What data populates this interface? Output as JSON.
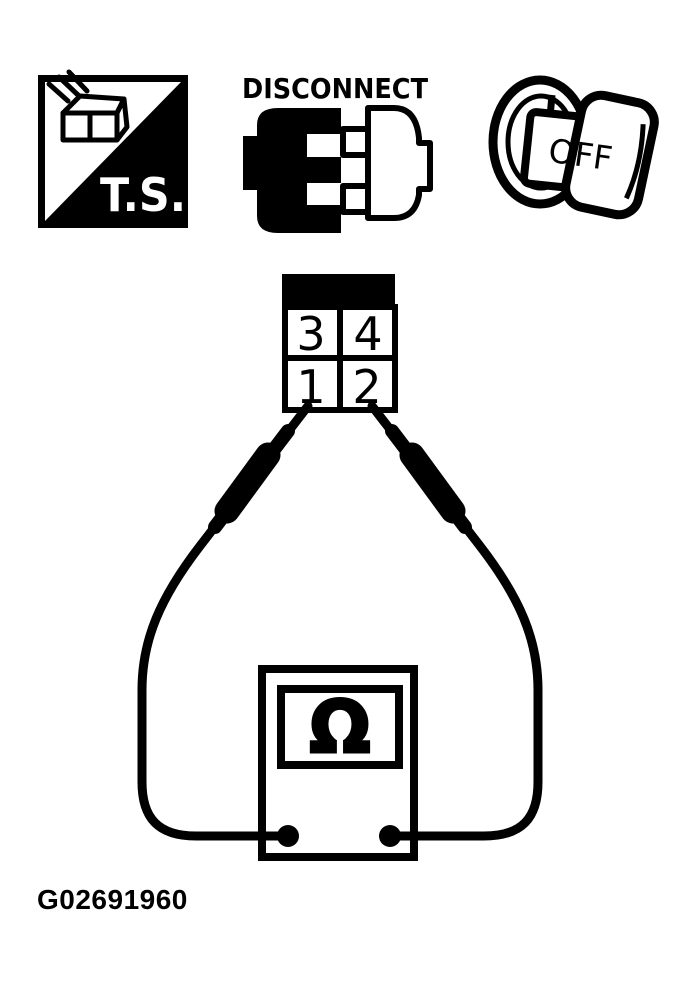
{
  "page": {
    "background": "#ffffff",
    "ink": "#000000",
    "figure_id": "G02691960"
  },
  "header_icons": {
    "test_switch": {
      "icon": "test-switch-icon",
      "label": "T.S."
    },
    "disconnect": {
      "icon": "disconnect-connectors-icon",
      "label": "DISCONNECT"
    },
    "ignition": {
      "icon": "ignition-key-off-icon",
      "label": "OFF"
    }
  },
  "connector": {
    "icon": "four-pin-connector-pinout",
    "pins": [
      "3",
      "4",
      "1",
      "2"
    ]
  },
  "meter": {
    "icon": "ohmmeter-icon",
    "symbol": "Ω"
  }
}
